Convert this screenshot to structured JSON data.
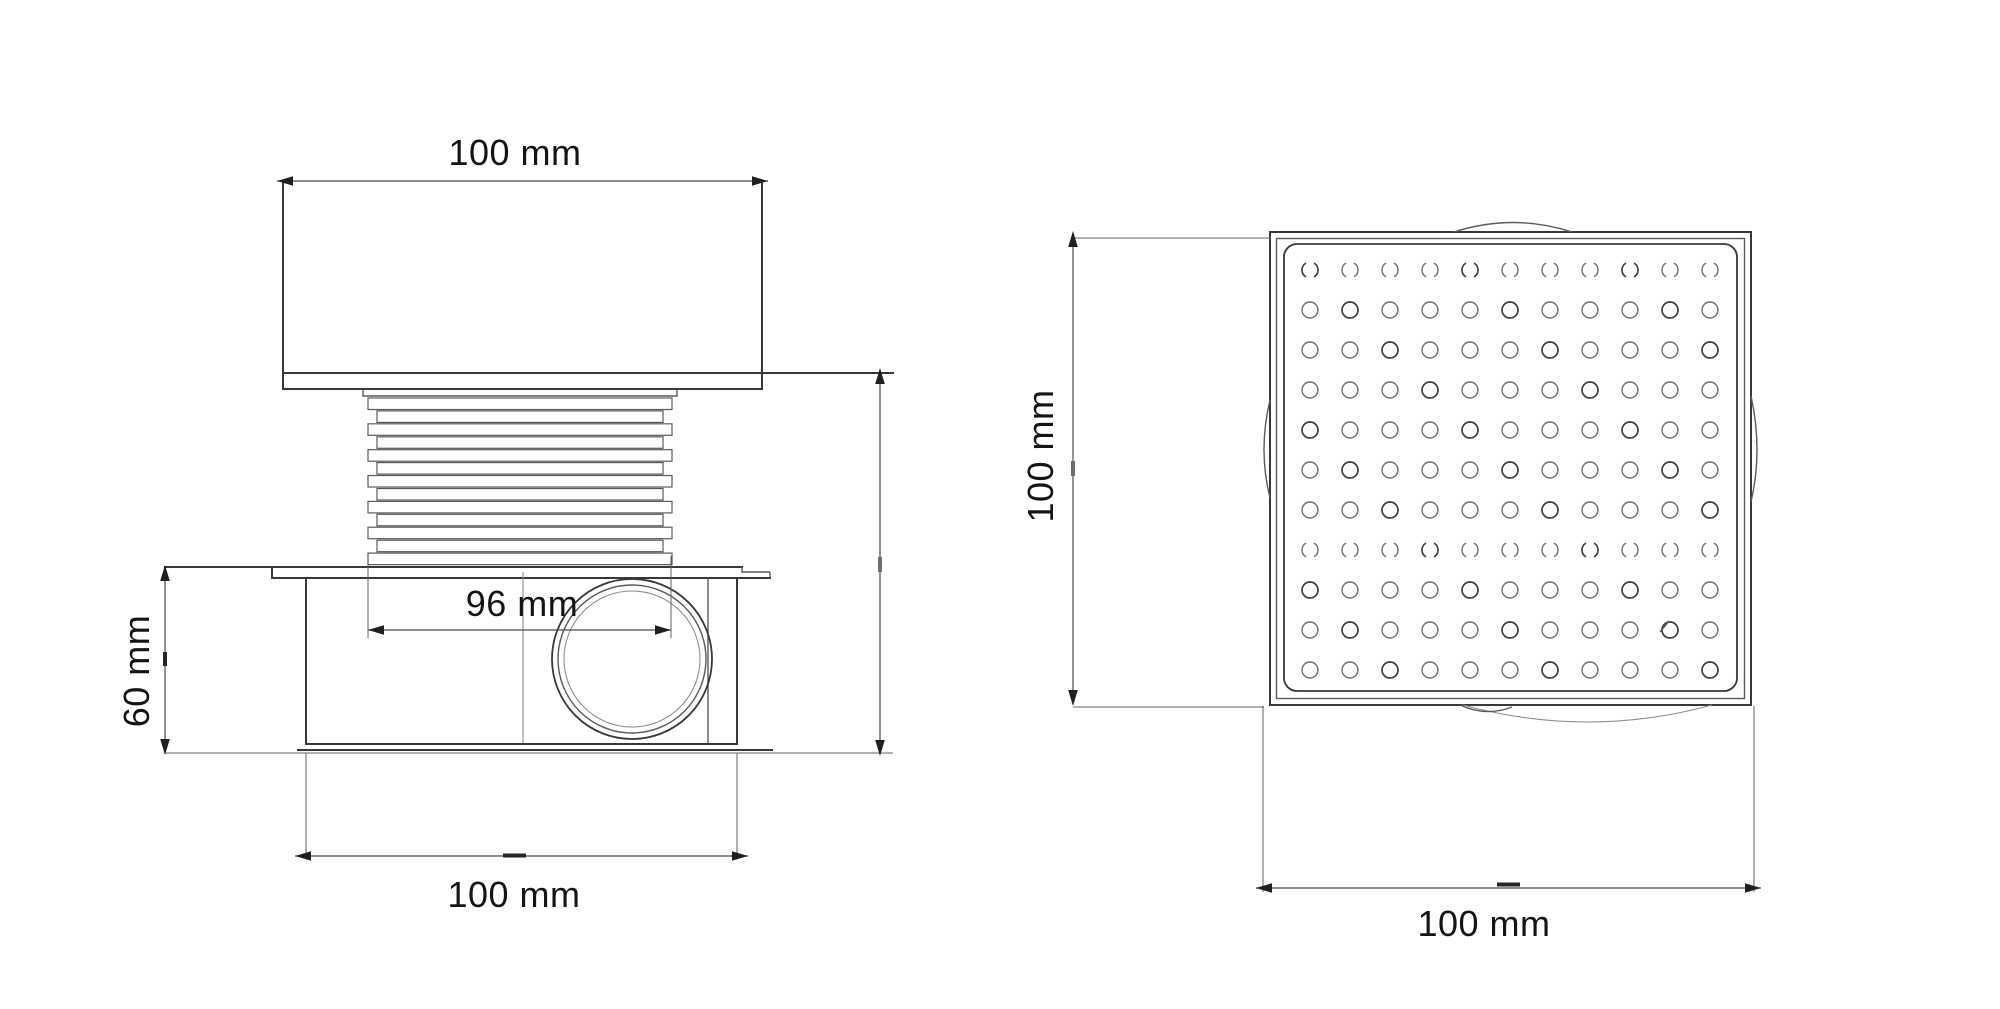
{
  "document": {
    "kind": "technical drawing - floor drain, two orthographic views",
    "colors": {
      "background": "#ffffff",
      "line": "#383838",
      "line_light": "#8d8d8d",
      "text": "#141414"
    }
  },
  "views": {
    "side": {
      "name": "side view",
      "thread_rings": 13,
      "dimensions": {
        "cap_width": {
          "label": "100 mm",
          "orientation": "horizontal",
          "position": "top"
        },
        "riser_width": {
          "label": "96 mm",
          "orientation": "horizontal",
          "position": "middle"
        },
        "body_height": {
          "label": "60 mm",
          "orientation": "vertical",
          "position": "left"
        },
        "body_width": {
          "label": "100 mm",
          "orientation": "horizontal",
          "position": "bottom"
        },
        "overall_height": {
          "label": "",
          "orientation": "vertical",
          "position": "right"
        }
      }
    },
    "top": {
      "name": "top view",
      "grate": {
        "rows": 11,
        "cols": 11,
        "broken_rows": [
          1,
          8
        ]
      },
      "dimensions": {
        "side_length_vertical": {
          "label": "100 mm",
          "orientation": "vertical",
          "position": "left"
        },
        "side_length_horizontal": {
          "label": "100 mm",
          "orientation": "horizontal",
          "position": "bottom"
        }
      }
    }
  }
}
